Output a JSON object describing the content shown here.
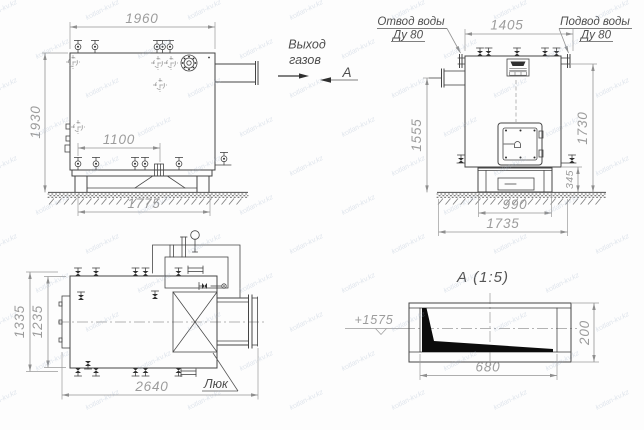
{
  "side_view": {
    "dim_width_top": "1960",
    "dim_height_left": "1930",
    "dim_inner_width": "1100",
    "dim_base_width": "1775"
  },
  "gas_outlet": {
    "line1": "Выход",
    "line2": "газов"
  },
  "section_mark": {
    "letter": "А"
  },
  "front_view": {
    "label_water_outlet_line1": "Отвод воды",
    "label_water_outlet_line2": "Ду 80",
    "label_water_inlet_line1": "Подвод воды",
    "label_water_inlet_line2": "Ду 80",
    "dim_width_top": "1405",
    "dim_height_left": "1555",
    "dim_height_right": "1730",
    "dim_base_height": "345",
    "dim_base_width": "990",
    "dim_foundation_width": "1735"
  },
  "plan_view": {
    "dim_height_outer": "1335",
    "dim_height_inner": "1235",
    "dim_width": "2640",
    "label_hatch": "Люк"
  },
  "section_a": {
    "title": "А (1:5)",
    "dim_width": "680",
    "dim_height": "200",
    "elevation": "+1575"
  },
  "watermark": {
    "text": "kotlan-kv.kz"
  }
}
